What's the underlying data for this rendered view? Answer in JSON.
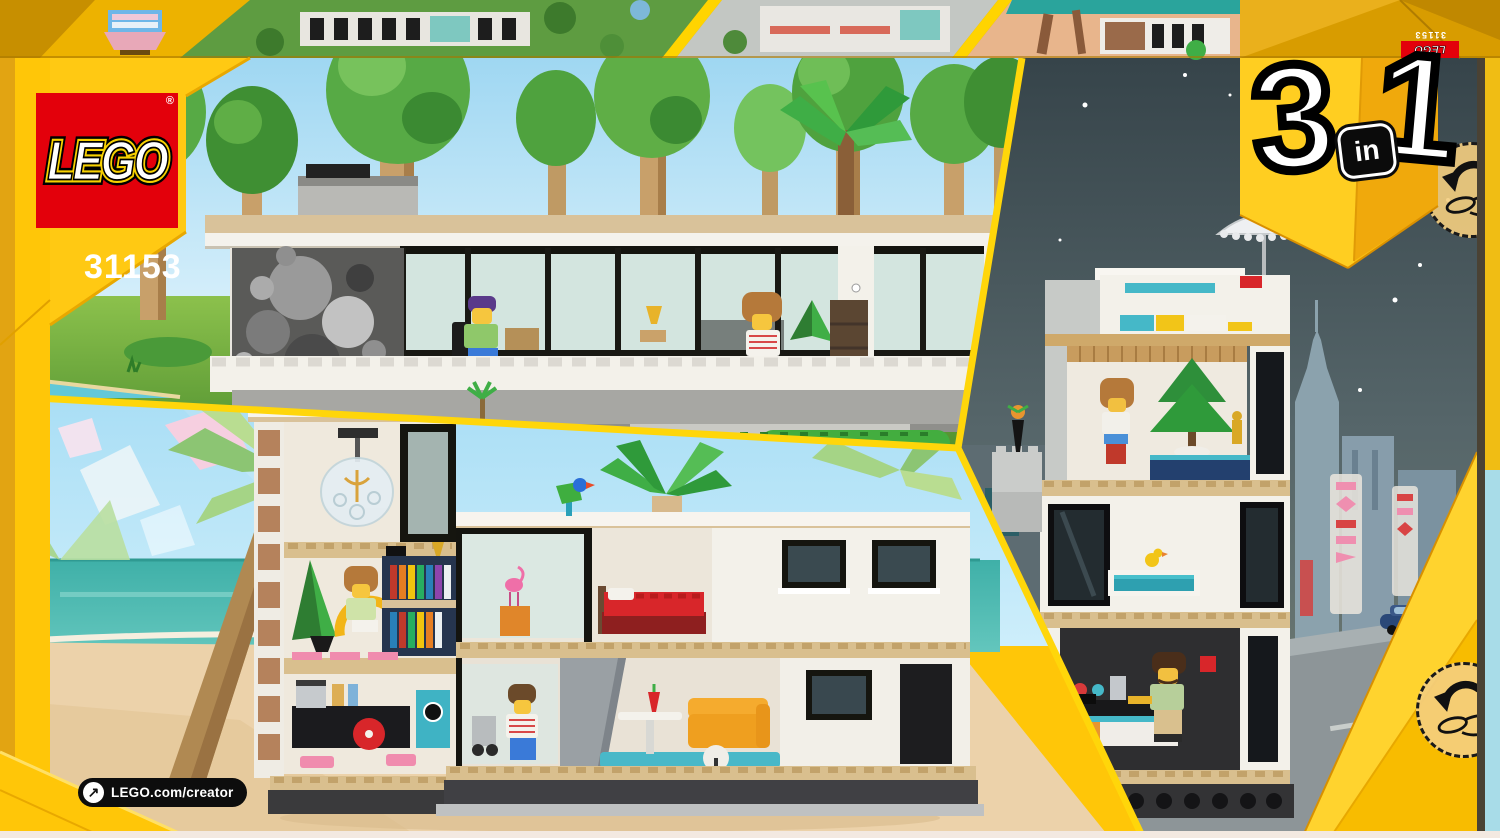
{
  "product": {
    "brand_wordmark": "LEGO",
    "registered_mark": "®",
    "set_number": "31153"
  },
  "badge_3in1": {
    "left_digit": "3",
    "middle_word": "in",
    "right_digit": "1"
  },
  "top_flap": {
    "brand_wordmark": "LEGO",
    "set_number": "31153"
  },
  "footer": {
    "website": "LEGO.com/creator",
    "arrow_icon": "↗"
  },
  "icons": {
    "rotate_hint": "hand-rotate-icon",
    "website_arrow": "arrow-up-right-icon"
  },
  "colors": {
    "frame_yellow": "#FFC608",
    "fold_orange": "#E2A412",
    "flap_orange": "#D89C00",
    "lego_red": "#E3000B",
    "badge_gold": "#F9C21A",
    "pill_black": "#0D0D0D",
    "day_sky": "#9FD9F2",
    "meadow_green": "#6FAE3E",
    "beach_sky": "#AADEF5",
    "ocean_teal": "#49B5AD",
    "sand": "#ECD2AA",
    "night_sky": "#3A4849",
    "roof_tan": "#D9C29A"
  }
}
